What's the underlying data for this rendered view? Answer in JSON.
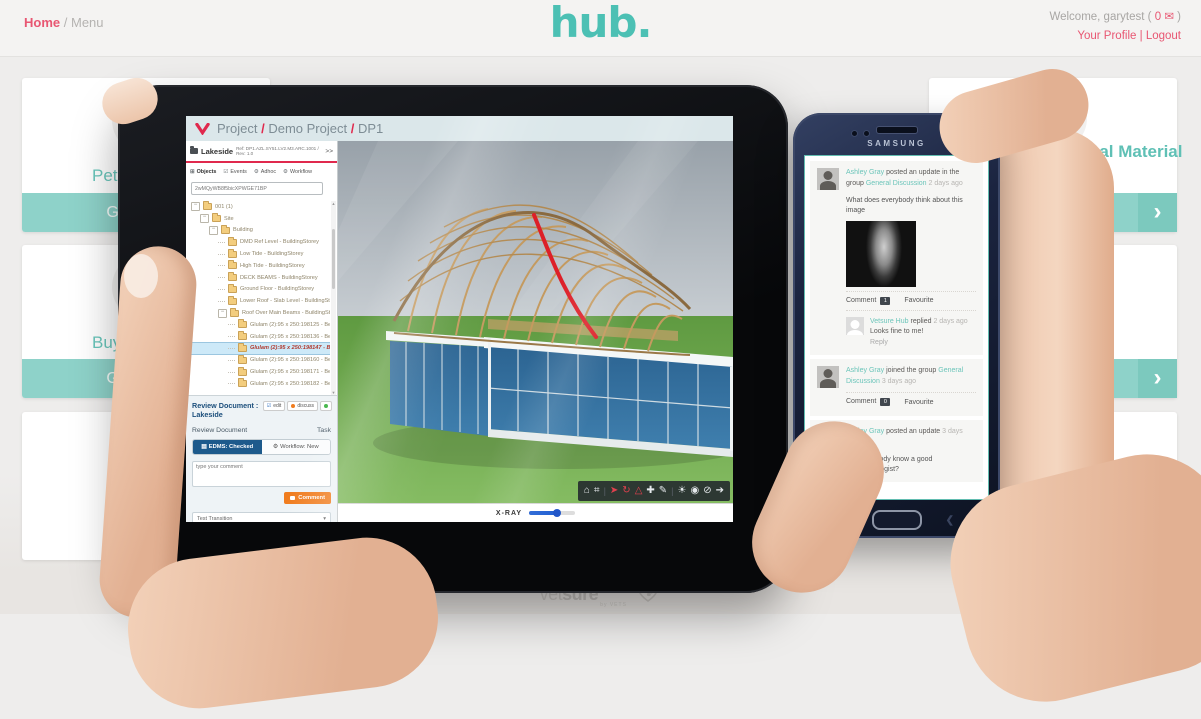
{
  "colors": {
    "teal": "#4cc0b4",
    "pink": "#e85672",
    "app_red": "#e0294d",
    "edms_blue": "#1d5a8c",
    "comment_orange": "#f07c1e",
    "transition_blue": "#2d9fd8",
    "slider_blue": "#2563d4",
    "link_teal": "#6cc5ba"
  },
  "header": {
    "breadcrumb": {
      "home": "Home",
      "separator": "/",
      "current": "Menu"
    },
    "logo": "hub.",
    "welcome": {
      "prefix": "Welcome, garytest (",
      "count": "0",
      "mail_glyph": "✉",
      "suffix": ")"
    },
    "profile_link": "Your Profile",
    "divider": "|",
    "logout_link": "Logout"
  },
  "cards": {
    "chevron_glyph": "›",
    "left": [
      {
        "title_fragment": "Pet In",
        "button_label": "Get started"
      },
      {
        "title_fragment": "Buyi",
        "button_label": "Get started"
      },
      {
        "title_fragment": "",
        "button_label": ""
      }
    ],
    "right": [
      {
        "title_fragment": "r Promotional Material",
        "button_label": "Get started",
        "icon": "target-icon"
      },
      {
        "title_fragment": "versation",
        "button_label": "Get started",
        "icon": "speech-bubble-icon",
        "icon_text": "\"Hello\""
      },
      {
        "title_fragment": "",
        "button_label": ""
      }
    ]
  },
  "tablet": {
    "app_header": {
      "project": "Project",
      "sep1": "/",
      "name": "Demo Project",
      "sep2": "/",
      "code": "DP1"
    },
    "doc": {
      "name": "Lakeside",
      "ref": "Ref: DP1.AZL.SY51.LV2.M3.ARC.1001 / Rev: 1.0",
      "expand": ">>"
    },
    "tabs": [
      {
        "label": "Objects",
        "glyph": "⊞"
      },
      {
        "label": "Events",
        "glyph": "☑"
      },
      {
        "label": "Adhoc",
        "glyph": "⚙"
      },
      {
        "label": "Workflow",
        "glyph": "⚙"
      }
    ],
    "search": {
      "value": "2wMQyWB8f5bicXPWGE71BP"
    },
    "tree": [
      {
        "label": "001 (1)"
      },
      {
        "label": "Site"
      },
      {
        "label": "Building"
      },
      {
        "label": "DMD Ref Level - BuildingStorey"
      },
      {
        "label": "Low Tide - BuildingStorey"
      },
      {
        "label": "High Tide - BuildingStorey"
      },
      {
        "label": "DECK BEAMS - BuildingStorey"
      },
      {
        "label": "Ground Floor - BuildingStorey"
      },
      {
        "label": "Lower Roof - Slab Level - BuildingStorey"
      },
      {
        "label": "Roof Over Main Beams - BuildingStorey"
      },
      {
        "label": "Glulam (2):95 x 250:198125 - Beam"
      },
      {
        "label": "Glulam (2):95 x 250:198136 - Beam"
      },
      {
        "label": "Glulam (2):95 x 250:198147 - Beam"
      },
      {
        "label": "Glulam (2):95 x 250:198160 - Beam"
      },
      {
        "label": "Glulam (2):95 x 250:198171 - Beam"
      },
      {
        "label": "Glulam (2):95 x 250:198182 - Beam"
      }
    ],
    "review": {
      "title_line1": "Review Document :",
      "title_line2": "Lakeside",
      "edit_label": "edit",
      "edit_glyph": "☑",
      "discuss_label": "discuss",
      "subtitle": "Review Document",
      "task_label": "Task",
      "tab_edms": "EDMS: Checked",
      "tab_edms_glyph": "▤",
      "tab_workflow": "Workflow: New",
      "tab_workflow_glyph": "⚙",
      "comment_placeholder": "type your comment",
      "comment_button": "Comment",
      "transition_select": "Test Transition",
      "select_caret": "▾",
      "transition_button": "Transition",
      "transition_glyph": "✔"
    },
    "viewer": {
      "xray_label": "X-RAY",
      "xray_percent": 60,
      "toolbar": [
        {
          "name": "home",
          "glyph": "⌂"
        },
        {
          "name": "tree-view",
          "glyph": "⌗"
        },
        {
          "name": "select",
          "glyph": "➤"
        },
        {
          "name": "orbit",
          "glyph": "↻"
        },
        {
          "name": "measure",
          "glyph": "△"
        },
        {
          "name": "pan",
          "glyph": "✚"
        },
        {
          "name": "markup",
          "glyph": "✎"
        },
        {
          "name": "light",
          "glyph": "☀"
        },
        {
          "name": "show-all",
          "glyph": "◉"
        },
        {
          "name": "hide",
          "glyph": "⊘"
        },
        {
          "name": "walk",
          "glyph": "➔"
        }
      ]
    }
  },
  "phone": {
    "brand": "SAMSUNG",
    "posts": [
      {
        "author": "Ashley Gray",
        "action": "posted an update in the group",
        "group": "General Discussion",
        "time": "2 days ago",
        "body": "What does everybody think about this image",
        "comment_label": "Comment",
        "comment_count": "1",
        "favourite_label": "Favourite",
        "reply": {
          "author": "Vetsure Hub",
          "action": "replied",
          "time": "2 days ago",
          "body": "Looks fine to me!",
          "reply_label": "Reply"
        }
      },
      {
        "author": "Ashley Gray",
        "action": "joined the group",
        "group": "General Discussion",
        "time": "3 days ago",
        "comment_label": "Comment",
        "comment_count": "0",
        "favourite_label": "Favourite"
      },
      {
        "author": "Ashley Gray",
        "action": "posted an update",
        "time": "3 days ago",
        "body": "Does anybody know a good ophthalmologist?"
      }
    ]
  },
  "footer": {
    "brand_a": "vet",
    "brand_b": "sure",
    "tagline": "by VETS"
  }
}
